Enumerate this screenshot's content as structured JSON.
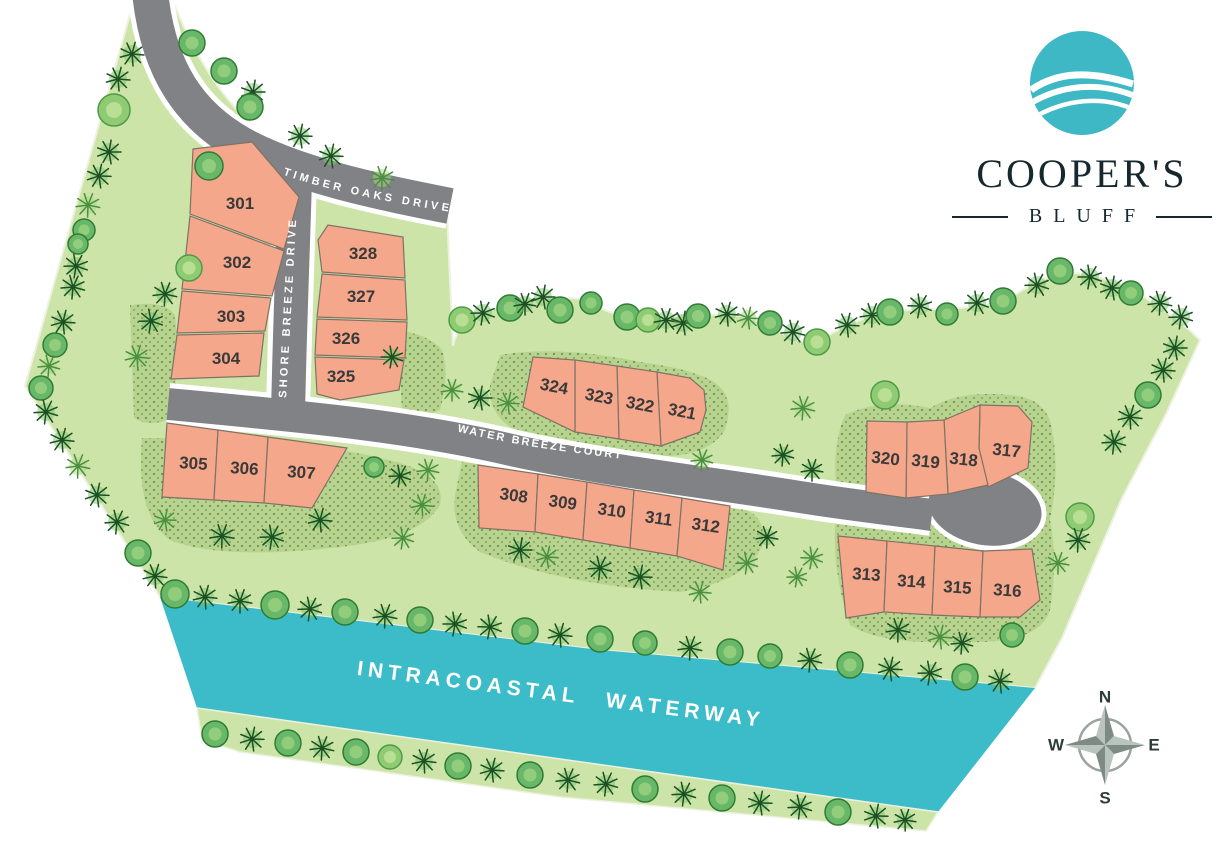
{
  "branding": {
    "name_line1": "COOPER'S",
    "name_line2": "BLUFF",
    "logo_color": "#3db8c4",
    "text_color": "#16282e"
  },
  "map": {
    "colors": {
      "background": "#ffffff",
      "land": "#cde4a9",
      "land_edge": "#edf2e0",
      "stipple": "#b7d48f",
      "dot": "#33511f",
      "water": "#3cbcc9",
      "road": "#818285",
      "road_casing": "#ffffff",
      "lot": "#f4a78a",
      "lot_border": "#7f7265",
      "lot_text": "#3a3a3a",
      "label_text": "#ffffff",
      "round_tree": "#69b86a",
      "round_tree_edge": "#2f7c33",
      "round_tree_inner": "#9ad07f",
      "round_tree_light": "#8fcb72",
      "round_tree_light_edge": "#4e9b46",
      "round_tree_light_inner": "#c0e39a",
      "palm_dark": "#1c4f22",
      "palm_dark_bg": "#7ac36e",
      "palm_light": "#4c8f3f",
      "palm_light_bg": "#a8d887",
      "compass_ring": "#99a49e",
      "compass_light": "#bac4be",
      "compass_dark": "#7e8a84",
      "compass_text": "#2e3d36"
    },
    "land_path": "M133,4 L25,386 L160,597 L600,650 L1035,688 L1062,638 L1122,498 L1166,414 L1200,340 C1186,326 1146,291 1098,277 C1064,267 1042,277 1012,297 C977,312 937,307 897,311 C867,314 846,326 821,339 C799,350 772,324 746,317 C718,313 698,315 670,317 C641,320 616,318 591,303 C577,295 562,300 545,297 C521,299 500,306 481,314 C466,320 456,330 453,346 L447,213 C400,196 342,173 292,151 C247,129 207,86 174,4 Z",
    "stipple_patches": [
      "M142,438 Q300,438 380,458 Q448,472 440,505 Q420,540 330,548 Q220,560 170,540 Q135,515 142,438 Z",
      "M462,462 Q600,480 740,508 Q768,515 762,545 Q750,580 680,592 Q560,585 480,552 Q450,530 455,495 Z",
      "M500,355 Q560,345 640,362 Q700,370 718,385 Q735,400 725,430 Q705,462 640,455 Q560,448 515,430 Q488,415 490,385 Z",
      "M398,330 Q430,335 442,350 Q450,375 440,410 Q420,420 402,412 Z",
      "M845,415 Q880,398 930,408 Q960,390 1010,395 Q1048,398 1052,430 Q1060,470 1050,520 Q1058,560 1050,610 Q1040,645 960,642 Q880,645 850,625 Q828,560 838,500 Q830,450 845,415 Z",
      "M130,305 Q165,300 175,315 Q180,360 172,418 Q150,428 134,418 Z"
    ],
    "water": {
      "points": "160,597 600,650 1035,688 938,812 197,708",
      "label": "INTRACOASTAL WATERWAY",
      "label_x": 560,
      "label_y": 701,
      "label_rot": 7.3
    },
    "lower_bank_points": "197,708 938,812 926,831 560,797 240,752 202,740",
    "roads": [
      {
        "name": "Timber Oaks Drive",
        "label": "TIMBER OAKS DRIVE",
        "path": "M150,-8 C158,70 190,118 248,148 C305,177 380,192 450,206",
        "w": 36,
        "label_path": "M281,174 C330,191 382,201 452,212",
        "ls": 11,
        "lsp": 3.5
      },
      {
        "name": "Shore Breeze Drive",
        "label": "SHORE BREEZE DRIVE",
        "path": "M295,178 C293,250 290,320 288,414",
        "w": 34,
        "label_path": "M286,400 L297,206",
        "ls": 11,
        "lsp": 3.2
      },
      {
        "name": "Water Breeze Court",
        "label": "WATER BREEZE COURT",
        "path": "M168,404 C320,418 420,428 520,452 C620,473 700,481 800,497 C850,505 888,509 932,515",
        "w": 32,
        "label_path": "M455,431 C520,446 565,452 640,461",
        "ls": 11,
        "lsp": 2.2
      }
    ],
    "culdesac": {
      "cx": 985,
      "cy": 508,
      "rx": 57,
      "ry": 37,
      "rot": 10
    },
    "lots": [
      {
        "id": "301",
        "pts": "193,149 252,142 299,197 284,249 190,214",
        "lx": 240,
        "ly": 209,
        "rot": 0
      },
      {
        "id": "302",
        "pts": "190,216 284,251 272,296 182,289",
        "lx": 237,
        "ly": 268,
        "rot": 0
      },
      {
        "id": "303",
        "pts": "182,291 271,298 265,331 177,333",
        "lx": 231,
        "ly": 322,
        "rot": 0
      },
      {
        "id": "304",
        "pts": "177,335 264,333 259,376 171,379",
        "lx": 226,
        "ly": 364,
        "rot": 0
      },
      {
        "id": "305",
        "pts": "167,423 218,430 214,500 162,497",
        "lx": 193,
        "ly": 469,
        "rot": 4
      },
      {
        "id": "306",
        "pts": "218,430 268,437 264,503 214,500",
        "lx": 244,
        "ly": 474,
        "rot": 4
      },
      {
        "id": "307",
        "pts": "268,437 347,448 312,508 264,503",
        "lx": 301,
        "ly": 478,
        "rot": 4
      },
      {
        "id": "308",
        "pts": "478,465 538,474 535,532 479,528",
        "lx": 513,
        "ly": 501,
        "rot": 8
      },
      {
        "id": "309",
        "pts": "538,474 587,482 583,540 535,532",
        "lx": 562,
        "ly": 508,
        "rot": 8
      },
      {
        "id": "310",
        "pts": "587,482 634,490 630,548 583,540",
        "lx": 611,
        "ly": 516,
        "rot": 8
      },
      {
        "id": "311",
        "pts": "634,490 682,498 677,556 630,548",
        "lx": 658,
        "ly": 524,
        "rot": 8
      },
      {
        "id": "312",
        "pts": "682,498 730,506 723,570 677,556",
        "lx": 705,
        "ly": 531,
        "rot": 8
      },
      {
        "id": "313",
        "pts": "838,536 887,541 884,612 846,618",
        "lx": 866,
        "ly": 580,
        "rot": 4
      },
      {
        "id": "314",
        "pts": "887,541 935,546 932,615 884,612",
        "lx": 911,
        "ly": 587,
        "rot": 4
      },
      {
        "id": "315",
        "pts": "935,546 983,551 980,617 932,615",
        "lx": 957,
        "ly": 593,
        "rot": 4
      },
      {
        "id": "316",
        "pts": "983,551 1032,549 1040,600 1020,617 980,617",
        "lx": 1007,
        "ly": 596,
        "rot": 4
      },
      {
        "id": "317",
        "pts": "980,405 1018,406 1032,422 1028,468 988,487 979,450",
        "lx": 1006,
        "ly": 456,
        "rot": 6
      },
      {
        "id": "318",
        "pts": "944,420 980,405 979,448 988,485 948,494",
        "lx": 963,
        "ly": 465,
        "rot": 6
      },
      {
        "id": "319",
        "pts": "907,422 944,420 948,494 906,498",
        "lx": 925,
        "ly": 467,
        "rot": 6
      },
      {
        "id": "320",
        "pts": "867,421 907,422 906,498 866,492",
        "lx": 885,
        "ly": 464,
        "rot": 6
      },
      {
        "id": "321",
        "pts": "657,372 690,378 704,390 706,410 700,432 661,446",
        "lx": 681,
        "ly": 417,
        "rot": 11
      },
      {
        "id": "322",
        "pts": "617,366 657,372 661,446 619,439",
        "lx": 639,
        "ly": 410,
        "rot": 11
      },
      {
        "id": "323",
        "pts": "575,360 617,366 619,439 575,432",
        "lx": 598,
        "ly": 402,
        "rot": 11
      },
      {
        "id": "324",
        "pts": "533,357 575,360 575,432 523,407",
        "lx": 553,
        "ly": 392,
        "rot": 11
      },
      {
        "id": "325",
        "pts": "315,357 404,360 399,390 340,400 317,394",
        "lx": 341,
        "ly": 382,
        "rot": 0
      },
      {
        "id": "326",
        "pts": "317,319 407,322 405,358 315,355",
        "lx": 346,
        "ly": 344,
        "rot": 0
      },
      {
        "id": "327",
        "pts": "322,274 405,280 407,320 317,317",
        "lx": 361,
        "ly": 302,
        "rot": 0
      },
      {
        "id": "328",
        "pts": "318,240 328,225 403,237 405,278 322,272",
        "lx": 363,
        "ly": 259,
        "rot": 0
      }
    ],
    "trees": [
      [
        192,
        43,
        13,
        0
      ],
      [
        224,
        71,
        13,
        0
      ],
      [
        253,
        92,
        12,
        1
      ],
      [
        300,
        136,
        12,
        1
      ],
      [
        331,
        156,
        12,
        1
      ],
      [
        382,
        178,
        12,
        2
      ],
      [
        132,
        54,
        12,
        1
      ],
      [
        118,
        79,
        12,
        1
      ],
      [
        114,
        110,
        16,
        3
      ],
      [
        109,
        152,
        12,
        1
      ],
      [
        99,
        176,
        12,
        1
      ],
      [
        88,
        205,
        12,
        2
      ],
      [
        84,
        230,
        11,
        0
      ],
      [
        78,
        244,
        10,
        0
      ],
      [
        76,
        266,
        12,
        1
      ],
      [
        73,
        287,
        12,
        1
      ],
      [
        63,
        322,
        12,
        1
      ],
      [
        55,
        345,
        12,
        0
      ],
      [
        49,
        366,
        11,
        2
      ],
      [
        41,
        388,
        12,
        0
      ],
      [
        46,
        412,
        12,
        1
      ],
      [
        62,
        440,
        12,
        1
      ],
      [
        78,
        466,
        12,
        2
      ],
      [
        97,
        495,
        12,
        1
      ],
      [
        117,
        522,
        12,
        1
      ],
      [
        138,
        553,
        13,
        0
      ],
      [
        155,
        576,
        12,
        1
      ],
      [
        250,
        107,
        13,
        0
      ],
      [
        209,
        166,
        14,
        0
      ],
      [
        189,
        268,
        13,
        3
      ],
      [
        165,
        294,
        12,
        1
      ],
      [
        151,
        321,
        12,
        1
      ],
      [
        137,
        357,
        12,
        2
      ],
      [
        222,
        536,
        12,
        1
      ],
      [
        272,
        537,
        12,
        1
      ],
      [
        320,
        520,
        12,
        1
      ],
      [
        374,
        467,
        10,
        0
      ],
      [
        400,
        476,
        11,
        1
      ],
      [
        428,
        470,
        11,
        2
      ],
      [
        422,
        505,
        11,
        2
      ],
      [
        403,
        538,
        11,
        2
      ],
      [
        165,
        520,
        11,
        2
      ],
      [
        520,
        550,
        12,
        1
      ],
      [
        547,
        557,
        11,
        2
      ],
      [
        600,
        568,
        12,
        1
      ],
      [
        640,
        577,
        12,
        1
      ],
      [
        700,
        592,
        11,
        2
      ],
      [
        462,
        320,
        13,
        3
      ],
      [
        483,
        313,
        12,
        1
      ],
      [
        510,
        308,
        13,
        0
      ],
      [
        525,
        304,
        11,
        1
      ],
      [
        543,
        297,
        12,
        1
      ],
      [
        560,
        310,
        13,
        0
      ],
      [
        591,
        303,
        11,
        0
      ],
      [
        627,
        317,
        13,
        0
      ],
      [
        648,
        320,
        12,
        3
      ],
      [
        666,
        320,
        12,
        1
      ],
      [
        683,
        323,
        12,
        1
      ],
      [
        698,
        316,
        12,
        0
      ],
      [
        727,
        314,
        12,
        1
      ],
      [
        748,
        318,
        11,
        2
      ],
      [
        770,
        323,
        12,
        0
      ],
      [
        793,
        332,
        12,
        1
      ],
      [
        817,
        342,
        13,
        3
      ],
      [
        847,
        325,
        12,
        1
      ],
      [
        872,
        315,
        12,
        1
      ],
      [
        890,
        312,
        13,
        0
      ],
      [
        920,
        306,
        12,
        1
      ],
      [
        947,
        314,
        11,
        0
      ],
      [
        977,
        303,
        12,
        1
      ],
      [
        1003,
        301,
        13,
        0
      ],
      [
        1037,
        285,
        12,
        1
      ],
      [
        1060,
        271,
        13,
        0
      ],
      [
        1090,
        277,
        12,
        1
      ],
      [
        1112,
        288,
        12,
        1
      ],
      [
        1131,
        293,
        12,
        0
      ],
      [
        1160,
        303,
        12,
        1
      ],
      [
        1181,
        317,
        12,
        1
      ],
      [
        1175,
        348,
        12,
        1
      ],
      [
        1163,
        370,
        12,
        1
      ],
      [
        1148,
        395,
        13,
        0
      ],
      [
        1130,
        417,
        12,
        1
      ],
      [
        1114,
        442,
        12,
        1
      ],
      [
        1080,
        517,
        14,
        3
      ],
      [
        1078,
        540,
        12,
        1
      ],
      [
        1058,
        563,
        11,
        2
      ],
      [
        452,
        390,
        11,
        2
      ],
      [
        480,
        398,
        12,
        1
      ],
      [
        508,
        403,
        11,
        2
      ],
      [
        392,
        357,
        11,
        1
      ],
      [
        702,
        460,
        11,
        2
      ],
      [
        803,
        408,
        12,
        2
      ],
      [
        885,
        395,
        14,
        3
      ],
      [
        783,
        455,
        11,
        1
      ],
      [
        812,
        470,
        11,
        1
      ],
      [
        767,
        537,
        11,
        1
      ],
      [
        747,
        563,
        11,
        2
      ],
      [
        812,
        558,
        11,
        2
      ],
      [
        797,
        577,
        10,
        2
      ],
      [
        898,
        630,
        12,
        1
      ],
      [
        940,
        637,
        12,
        2
      ],
      [
        1012,
        635,
        12,
        0
      ],
      [
        962,
        643,
        11,
        1
      ],
      [
        175,
        594,
        14,
        0
      ],
      [
        205,
        597,
        12,
        1
      ],
      [
        240,
        601,
        12,
        1
      ],
      [
        275,
        605,
        14,
        0
      ],
      [
        310,
        609,
        12,
        1
      ],
      [
        345,
        612,
        13,
        0
      ],
      [
        385,
        616,
        12,
        1
      ],
      [
        420,
        620,
        13,
        0
      ],
      [
        455,
        624,
        12,
        1
      ],
      [
        490,
        627,
        12,
        1
      ],
      [
        525,
        631,
        13,
        0
      ],
      [
        560,
        635,
        12,
        1
      ],
      [
        600,
        639,
        13,
        0
      ],
      [
        645,
        643,
        12,
        0
      ],
      [
        690,
        648,
        12,
        1
      ],
      [
        730,
        652,
        13,
        0
      ],
      [
        770,
        656,
        12,
        0
      ],
      [
        810,
        660,
        12,
        1
      ],
      [
        850,
        665,
        13,
        0
      ],
      [
        890,
        669,
        12,
        1
      ],
      [
        930,
        673,
        12,
        1
      ],
      [
        965,
        677,
        13,
        0
      ],
      [
        1000,
        681,
        12,
        1
      ],
      [
        215,
        734,
        13,
        0
      ],
      [
        252,
        739,
        12,
        1
      ],
      [
        288,
        743,
        13,
        0
      ],
      [
        322,
        748,
        12,
        1
      ],
      [
        356,
        752,
        13,
        0
      ],
      [
        390,
        757,
        12,
        3
      ],
      [
        424,
        761,
        12,
        1
      ],
      [
        458,
        766,
        13,
        0
      ],
      [
        492,
        770,
        12,
        1
      ],
      [
        530,
        775,
        13,
        0
      ],
      [
        568,
        780,
        12,
        1
      ],
      [
        606,
        784,
        12,
        1
      ],
      [
        645,
        789,
        13,
        0
      ],
      [
        684,
        794,
        12,
        1
      ],
      [
        722,
        798,
        13,
        0
      ],
      [
        760,
        803,
        12,
        1
      ],
      [
        800,
        807,
        12,
        1
      ],
      [
        838,
        812,
        13,
        0
      ],
      [
        876,
        816,
        12,
        1
      ],
      [
        905,
        820,
        11,
        1
      ]
    ],
    "compass": {
      "x": 1105,
      "y": 745,
      "n": "N",
      "e": "E",
      "s": "S",
      "w": "W"
    }
  }
}
